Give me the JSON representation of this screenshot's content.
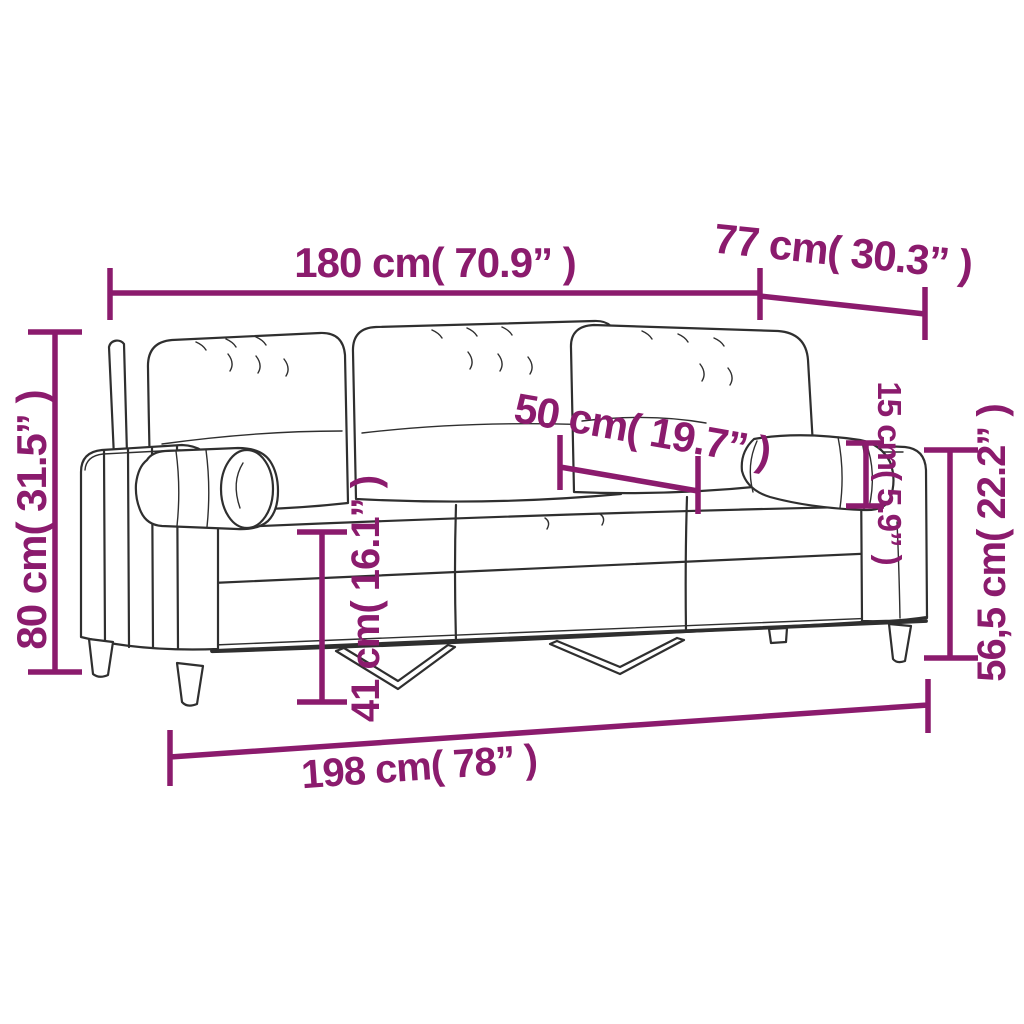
{
  "diagram": {
    "illustration": "three-seater-sofa-with-bolster-pillows-line-drawing",
    "colors": {
      "accent": "#8b1b6d",
      "line_art": "#2f2f2f",
      "background": "#ffffff"
    },
    "dimensions": {
      "back_width": "180 cm( 70.9” )",
      "depth": "77 cm( 30.3” )",
      "back_height": "80 cm( 31.5” )",
      "seat_depth": "50 cm( 19.7” )",
      "seat_height": "41 cm( 16.1” )",
      "pillow_diameter": "15 cm( 5.9” )",
      "arm_height": "56,5 cm( 22.2” )",
      "total_width": "198 cm( 78” )"
    }
  }
}
